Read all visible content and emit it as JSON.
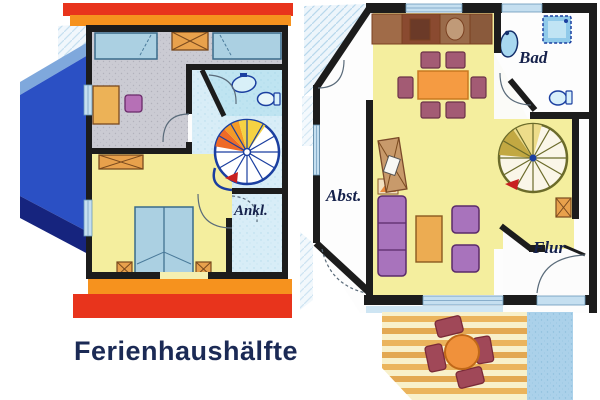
{
  "caption": "Ferienhaushälfte",
  "labels": {
    "ankl": "Ankl.",
    "bad": "Bad",
    "abst": "Abst.",
    "flur": "Flur"
  },
  "plans": {
    "upper_floor": {
      "rooms": [
        "carpet-bedroom",
        "bathroom",
        "landing",
        "yellow-bedroom",
        "dressing-area"
      ],
      "fixtures": [
        "single-bed",
        "single-bed",
        "wardrobe",
        "desk",
        "stool",
        "sink",
        "toilet",
        "spiral-staircase",
        "double-bed",
        "nightstand",
        "nightstand",
        "roof-gable"
      ]
    },
    "ground_floor": {
      "rooms": [
        "kitchen-living-room",
        "bathroom",
        "storage-room",
        "hallway",
        "terrace"
      ],
      "fixtures": [
        "kitchen-counter",
        "dining-table",
        "dining-chairs",
        "shower",
        "sink",
        "toilet",
        "spiral-staircase",
        "sofa",
        "coffee-table",
        "armchair",
        "armchair",
        "tv-unit",
        "garden-table",
        "garden-chairs"
      ]
    }
  },
  "colors": {
    "roof_red": "#E8341C",
    "roof_orange": "#F6921E",
    "wall_black": "#1C1C1C",
    "floor_yellow": "#F4EE9E",
    "floor_carpet_gray": "#CBCBD3",
    "floor_bath_blue": "#BFE4F1",
    "landing_blue": "#D8EDF7",
    "bed_blue": "#ABD0E2",
    "furniture_orange": "#E8A14C",
    "sofa_purple": "#A873BC",
    "chair_mauve": "#A35B74",
    "table_orange": "#F59B42",
    "counter_brown": "#9A6B4A",
    "gable_light_blue": "#7FA8DC",
    "gable_royal_blue": "#2B50C4",
    "gable_navy": "#16247E",
    "terrace_stripe_orange": "#EBB45C",
    "terrace_path_blue": "#ABD1EA",
    "stair_outline_blue": "#1B3FA0",
    "stair_outline_olive": "#6B6B2A",
    "label_navy": "#15214B"
  }
}
